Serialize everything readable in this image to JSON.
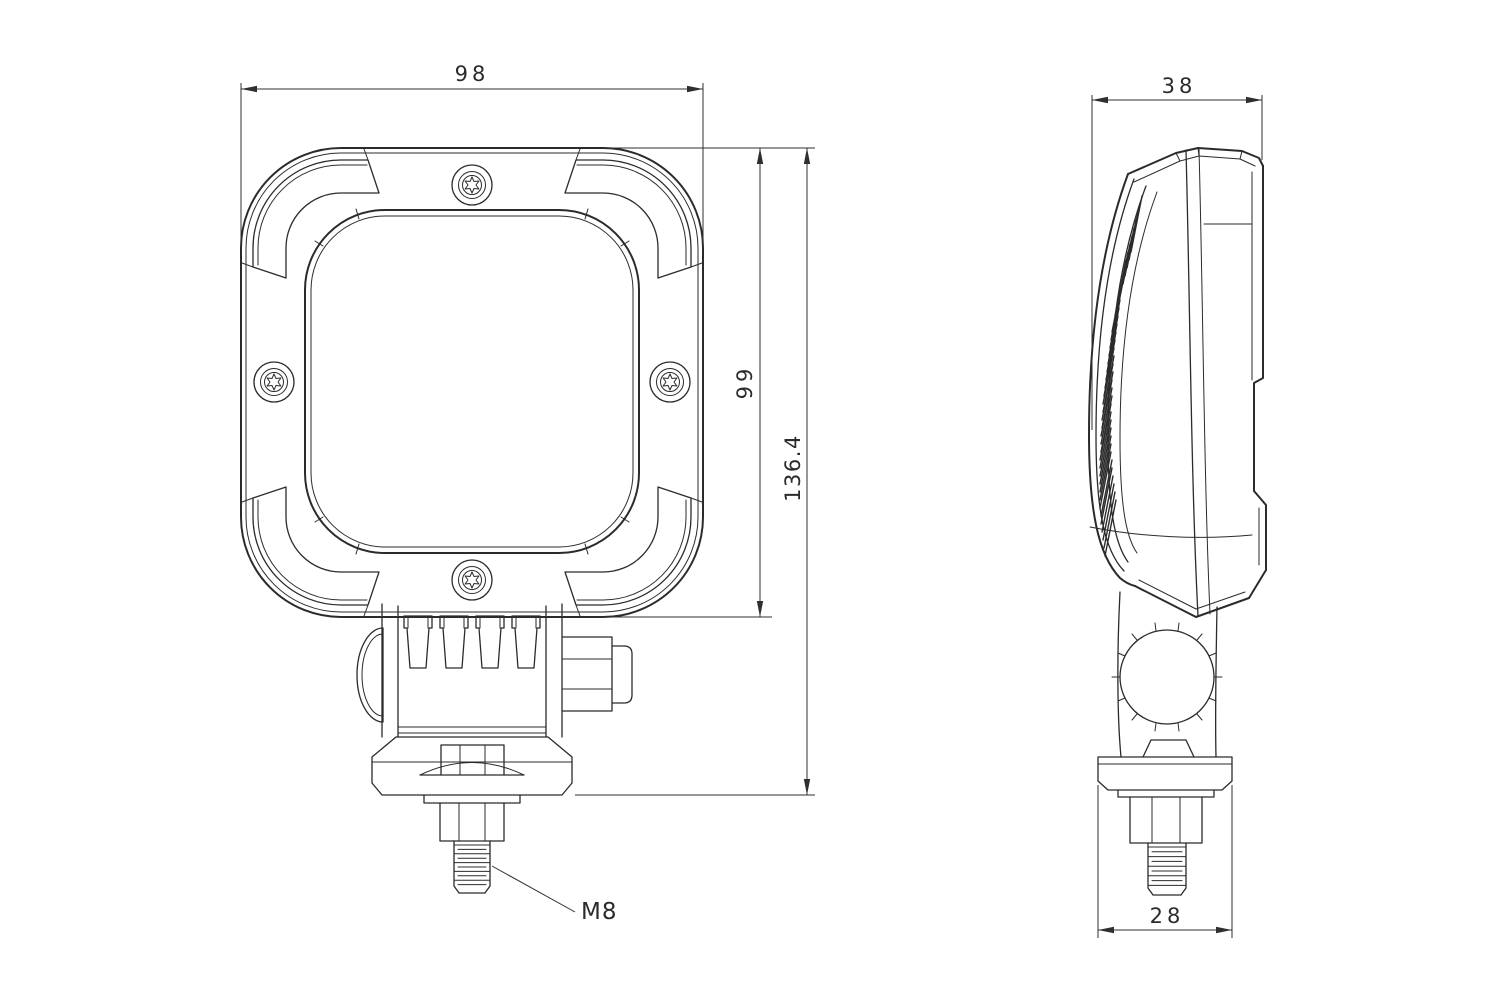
{
  "drawing": {
    "type": "technical-drawing",
    "subject": "square work lamp with mounting bracket, front and side orthographic views",
    "background_color": "#ffffff",
    "line_color": "#2b2b2b",
    "front_view": {
      "width_dim": "98",
      "body_height_dim": "99",
      "total_height_dim": "136.4",
      "thread_callout": "M8"
    },
    "side_view": {
      "depth_dim": "38",
      "base_width_dim": "28"
    }
  }
}
